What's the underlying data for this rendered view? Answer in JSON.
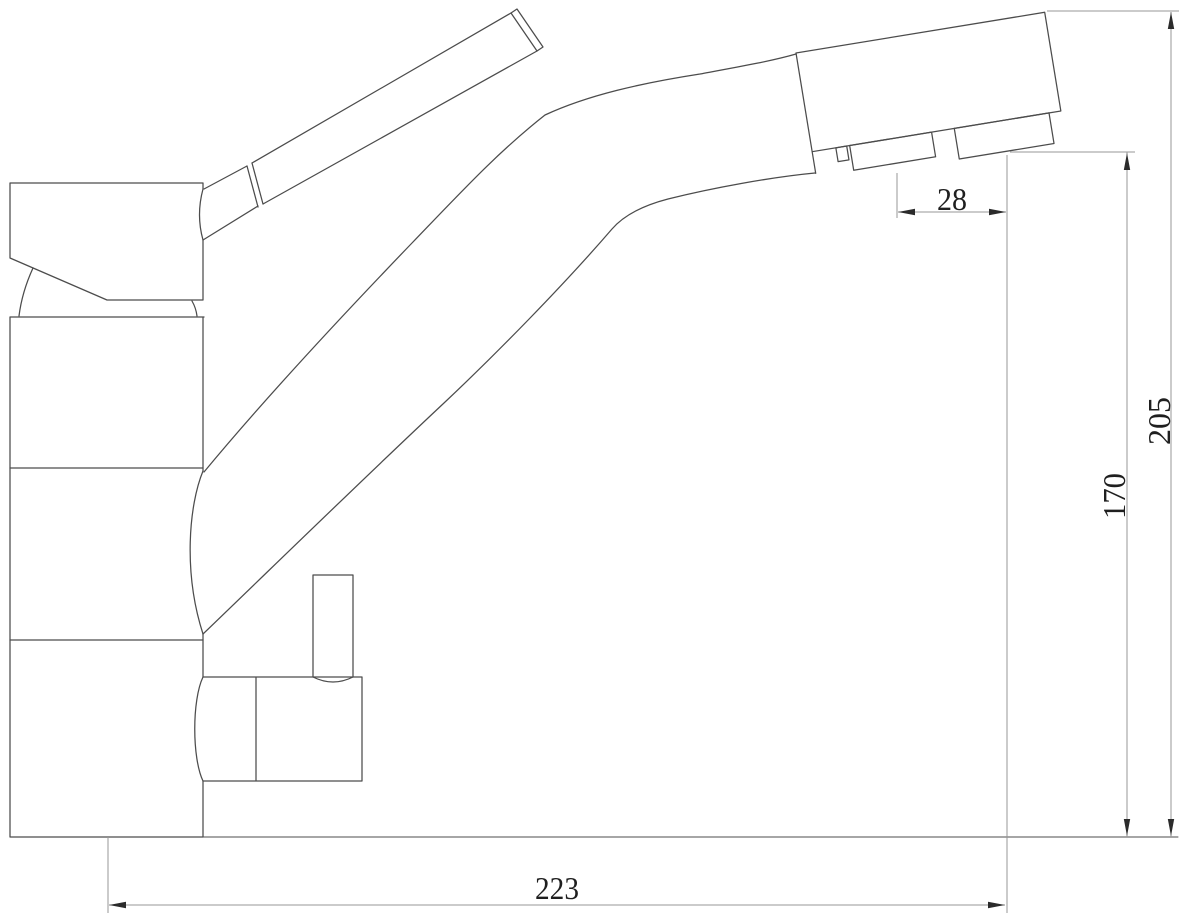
{
  "drawing": {
    "background_color": "#ffffff",
    "outline_color": "#4c4c4c",
    "dimension_line_color": "#979797",
    "arrow_color": "#2b2b2b",
    "text_color": "#1f1f1f",
    "dimensions": {
      "aerator_spacing": "28",
      "outlet_height": "170",
      "total_height": "205",
      "spout_reach": "223"
    }
  }
}
